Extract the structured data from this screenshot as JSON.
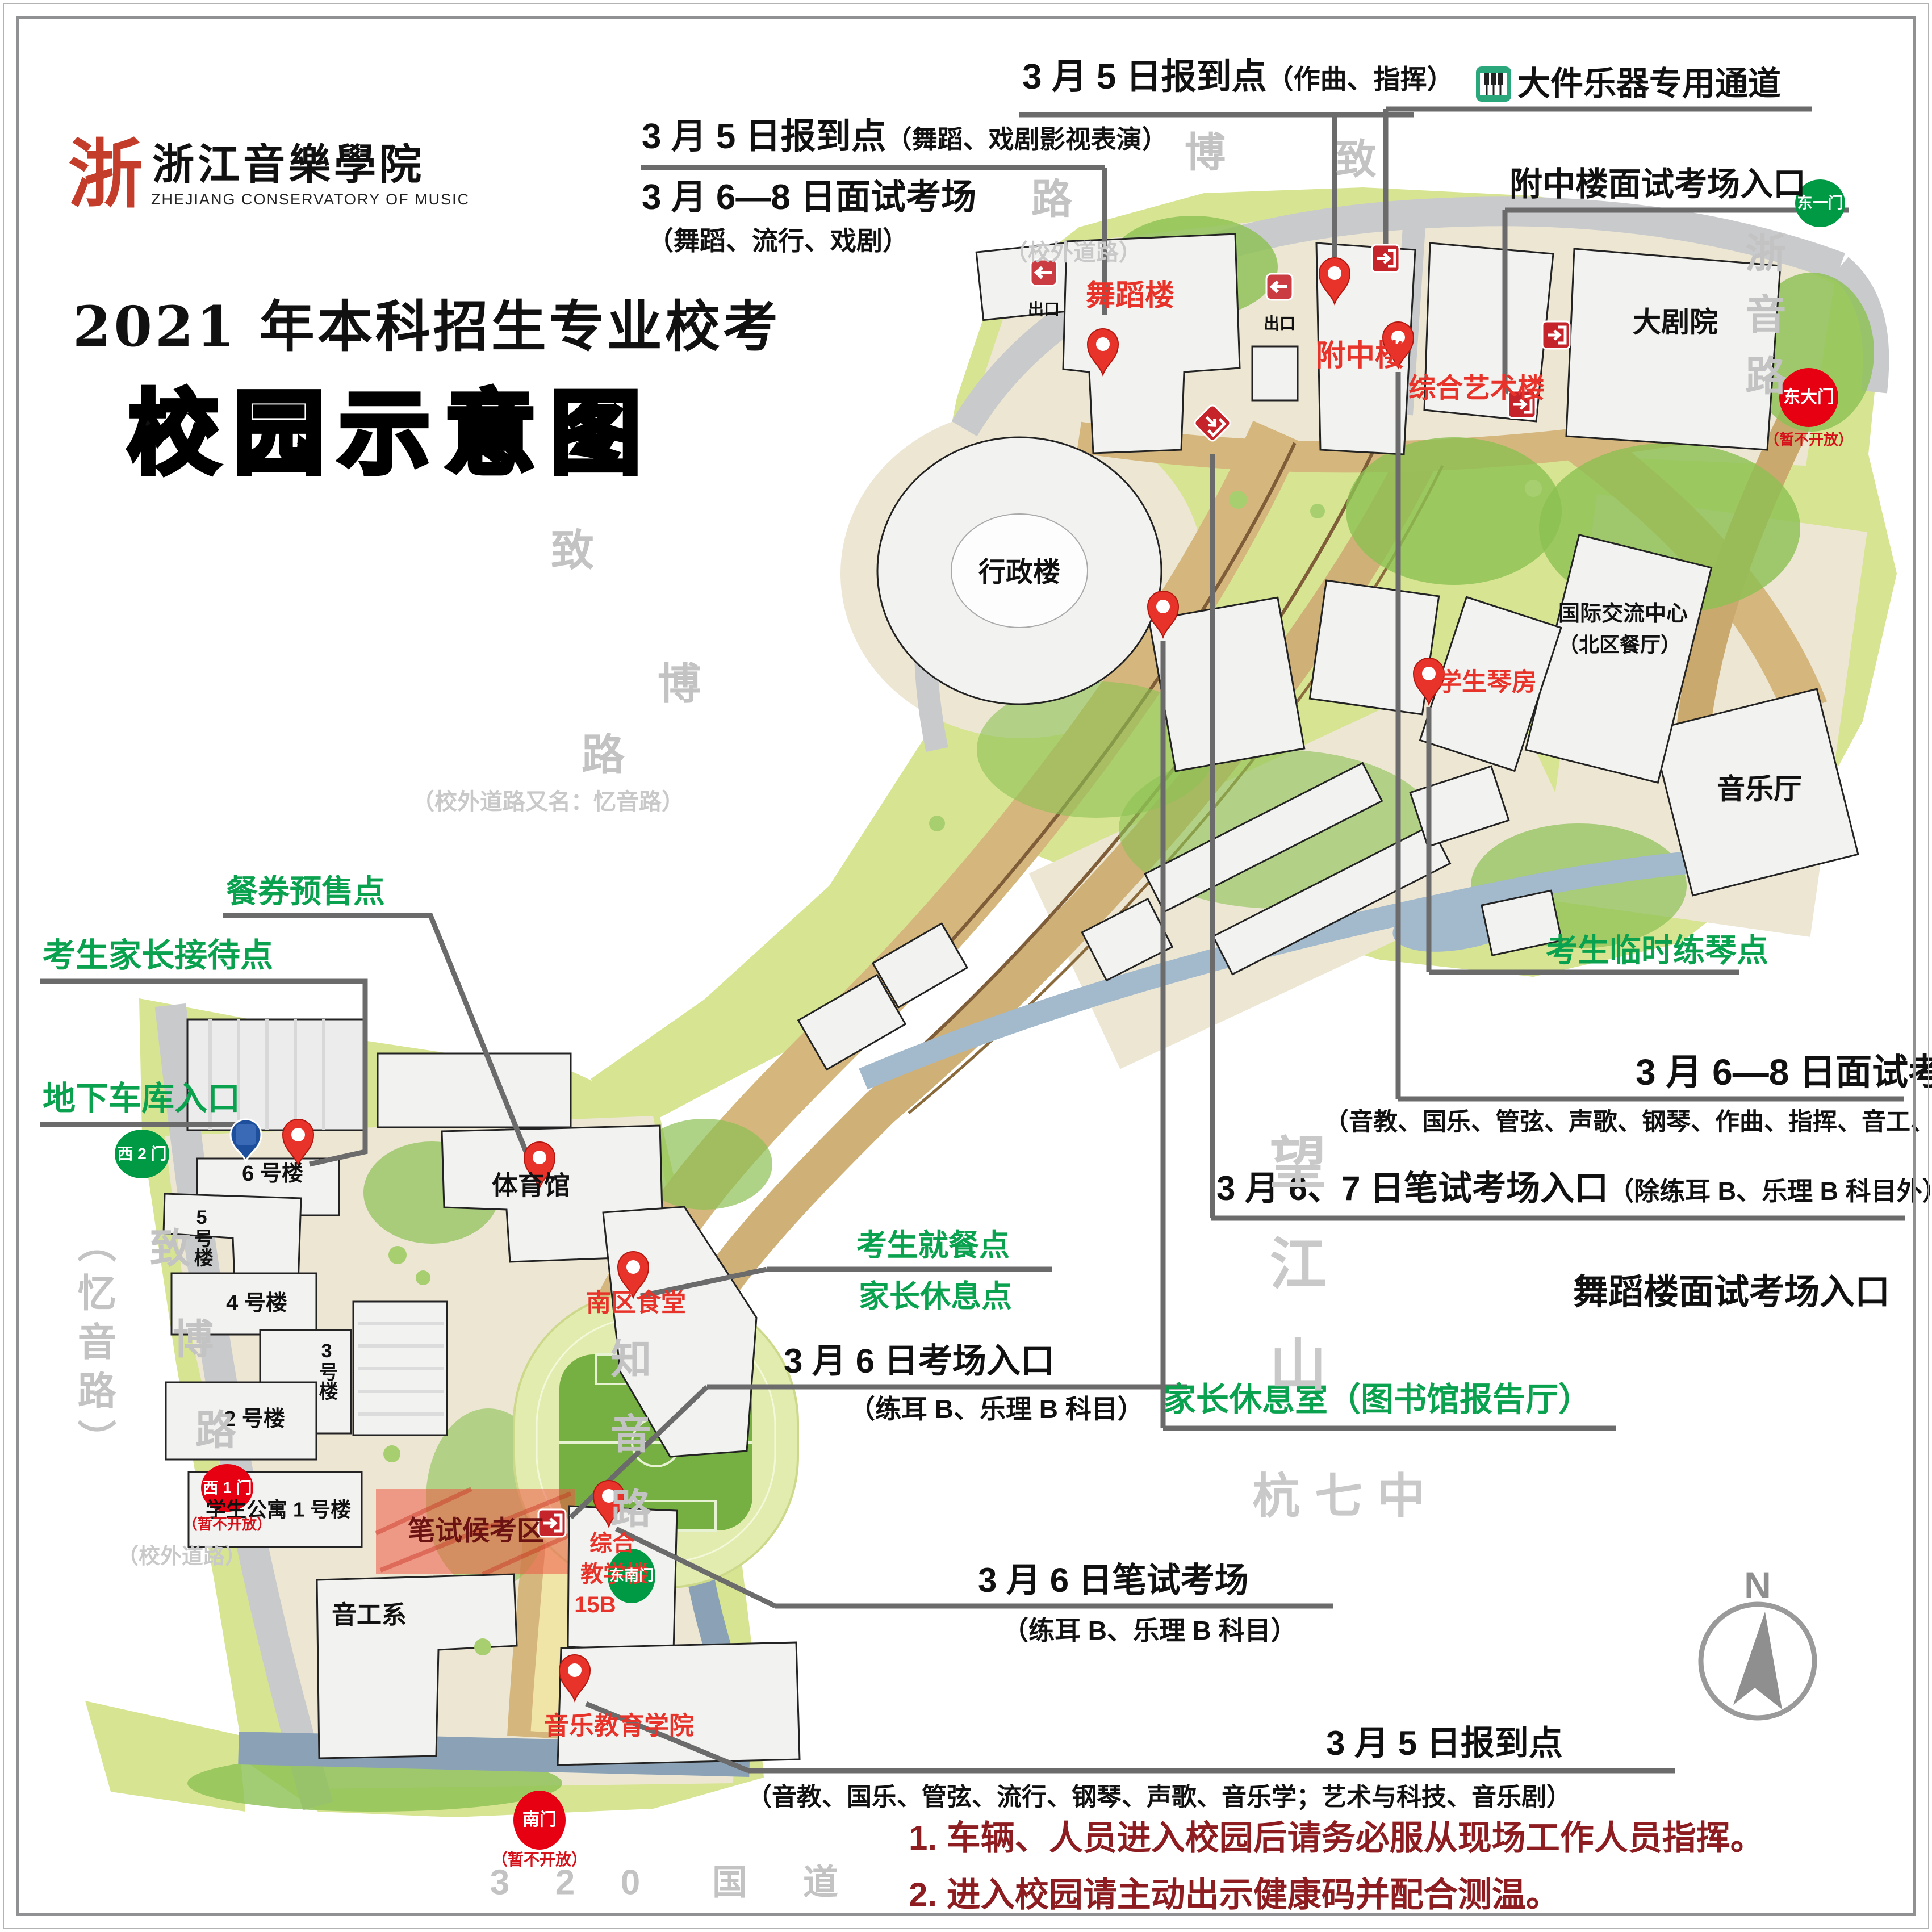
{
  "header": {
    "logo_mark": "浙",
    "logo_cn": "浙江音樂學院",
    "logo_en": "ZHEJIANG CONSERVATORY OF MUSIC",
    "title_line1": "2021 年本科招生专业校考",
    "title_line2": "校园示意图"
  },
  "callouts": {
    "baodao35_zuoqu": {
      "main": "3 月 5 日报到点",
      "sub": "（作曲、指挥）"
    },
    "baodao35_wudao": {
      "main": "3 月 5 日报到点",
      "sub": "（舞蹈、戏剧影视表演）"
    },
    "mianshi68_wudao": {
      "main": "3 月 6—8 日面试考场",
      "sub": "（舞蹈、流行、戏剧）"
    },
    "dajian": {
      "label": "大件乐器专用通道"
    },
    "fuzhong_entrance": {
      "label": "附中楼面试考场入口"
    },
    "lianqin": {
      "label": "考生临时练琴点"
    },
    "mianshi68": {
      "main": "3 月 6—8 日面试考场",
      "sub": "（音教、国乐、管弦、声歌、钢琴、作曲、指挥、音工、音乐学）"
    },
    "bishi67": {
      "main": "3 月 6、7 日笔试考场入口",
      "sub": "（除练耳 B、乐理 B 科目外）"
    },
    "wudao_entrance": {
      "label": "舞蹈楼面试考场入口"
    },
    "jiazhang_room": {
      "label": "家长休息室（图书馆报告厅）"
    },
    "canquan": {
      "label": "餐券预售点"
    },
    "jiazhang_jiedai": {
      "label": "考生家长接待点"
    },
    "cheku": {
      "label": "地下车库入口"
    },
    "jiucan": {
      "line1": "考生就餐点",
      "line2": "家长休息点"
    },
    "kaochang36": {
      "main": "3 月 6 日考场入口",
      "sub": "（练耳 B、乐理 B 科目）"
    },
    "bishi36": {
      "main": "3 月 6 日笔试考场",
      "sub": "（练耳 B、乐理 B 科目）"
    },
    "baodao35_main": {
      "main": "3 月 5 日报到点",
      "sub": "（音教、国乐、管弦、流行、钢琴、声歌、音乐学；艺术与科技、音乐剧）"
    }
  },
  "buildings": {
    "wudaolou": "舞蹈楼",
    "fuzhonglou": "附中楼",
    "zongyilou": "综合艺术楼",
    "dajuyuan": "大剧院",
    "yinyueting": "音乐厅",
    "guoji_line1": "国际交流中心",
    "guoji_line2": "（北区餐厅）",
    "qinfang": "学生琴房",
    "xingzhenglou": "行政楼",
    "tiyuguan": "体育馆",
    "nanqushitang": "南区食堂",
    "b6": "6 号楼",
    "b5": "5号楼",
    "b4": "4 号楼",
    "b3": "3号楼",
    "b2": "2 号楼",
    "gongyu1": "学生公寓 1 号楼",
    "yingongxi": "音工系",
    "zonghe_line1": "综合",
    "zonghe_line2": "教学楼",
    "zonghe_line3": "15B",
    "yinjiao": "音乐教育学院",
    "bishihoukaoqu": "笔试候考区",
    "chukou": "出口"
  },
  "gates": {
    "dongyi": {
      "label": "东一门"
    },
    "dongda": {
      "label": "东大门",
      "note": "（暂不开放）"
    },
    "xi2": {
      "label": "西 2 门"
    },
    "xi1": {
      "label": "西 1 门",
      "note": "（暂不开放）"
    },
    "dongnan": {
      "label": "东南门"
    },
    "nan": {
      "label": "南门",
      "note": "（暂不开放）"
    }
  },
  "roads": {
    "top": {
      "chars": [
        "路",
        "博",
        "致"
      ],
      "note": "（校外道路）"
    },
    "mid": {
      "chars": [
        "致",
        "博",
        "路"
      ],
      "note": "（校外道路又名：忆音路）"
    },
    "west": {
      "chars": [
        "致",
        "博",
        "路"
      ],
      "alt": "（忆音路）",
      "note": "（校外道路）"
    },
    "zheyin": "浙音路",
    "zhiyin": "知音路",
    "wangjiangshan": "望江山",
    "hangqizhong": "杭七中",
    "g320": {
      "chars": [
        "3",
        "2",
        "0",
        "国",
        "道"
      ]
    }
  },
  "notes": [
    "1. 车辆、人员进入校园后请务必服从现场工作人员指挥。",
    "2. 进入校园请主动出示健康码并配合测温。"
  ],
  "icons": {
    "parking": "P"
  },
  "compass": {
    "label": "N"
  },
  "colors": {
    "campus_green": "#d7e492",
    "accent_red": "#e8332a",
    "callout_green": "#0aa24f",
    "note_darkred": "#8d1d20",
    "gate_green": "#009944",
    "gate_red": "#e60012"
  }
}
